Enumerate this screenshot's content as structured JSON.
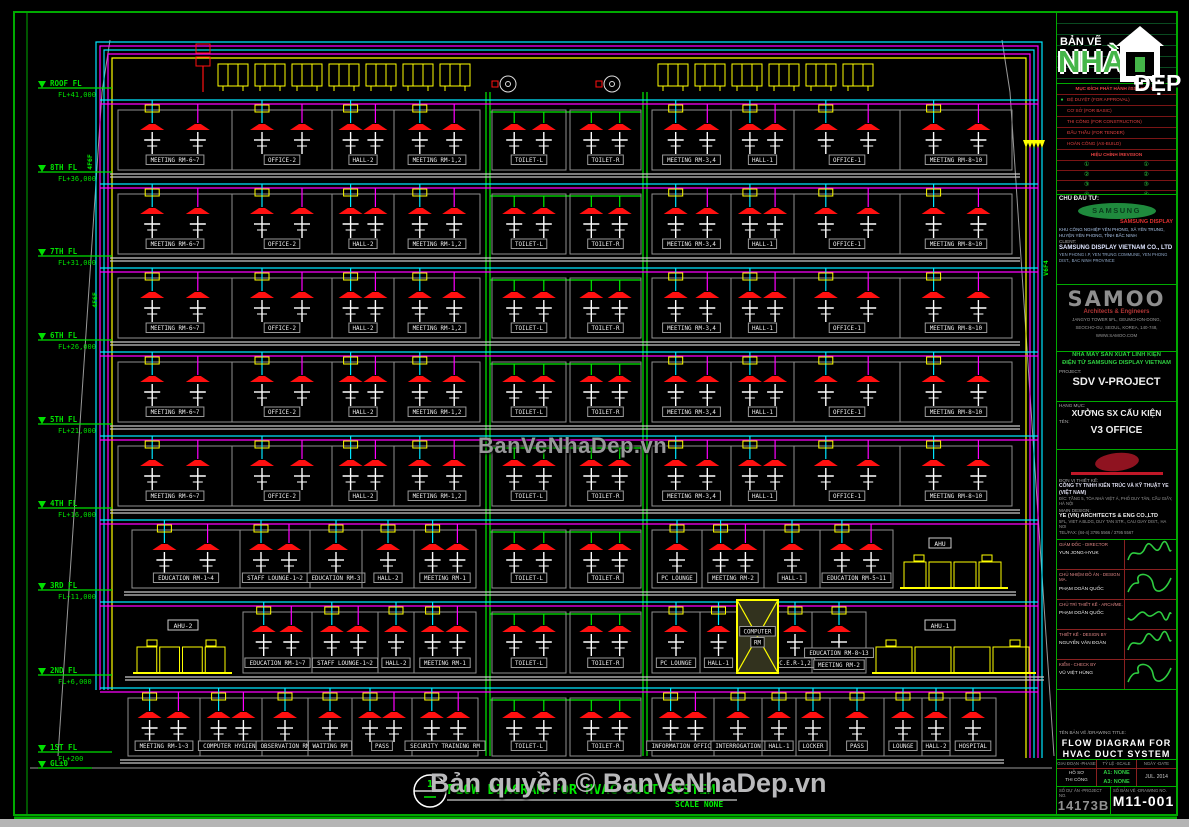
{
  "colors": {
    "supply": "#00e5ff",
    "return": "#ff00ff",
    "exhaust": "#00ee00",
    "equipment": "#ffff00",
    "diffuser": "#ff1010",
    "level": "#00e000",
    "border": "#00aa00"
  },
  "watermarks": {
    "center": "BanVeNhaDep.vn",
    "bottom": "Bản quyền © BanVeNhaDep.vn"
  },
  "footer": {
    "bubble_no": "1",
    "title": "FLOW DIAGRAM FOR HVAC DUCT SYSTEM",
    "scale": "SCALE  NONE"
  },
  "levels": [
    {
      "label": "ROOF FL",
      "elev": "FL+41,000",
      "y": 88
    },
    {
      "label": "8TH FL",
      "elev": "FL+36,000",
      "y": 172
    },
    {
      "label": "7TH FL",
      "elev": "FL+31,000",
      "y": 256
    },
    {
      "label": "6TH FL",
      "elev": "FL+26,000",
      "y": 340
    },
    {
      "label": "5TH FL",
      "elev": "FL+21,000",
      "y": 424
    },
    {
      "label": "4TH FL",
      "elev": "FL+16,000",
      "y": 508
    },
    {
      "label": "3RD FL",
      "elev": "FL+11,000",
      "y": 590
    },
    {
      "label": "2ND FL",
      "elev": "FL+6,000",
      "y": 675
    },
    {
      "label": "1ST FL",
      "elev": "FL+200",
      "y": 752
    },
    {
      "label": "GL±0",
      "elev": "",
      "y": 768
    }
  ],
  "riser_tags": [
    {
      "text": "4F6F",
      "x": 92,
      "y": 162,
      "rot": -90
    },
    {
      "text": "4F6F",
      "x": 97,
      "y": 300,
      "rot": -90
    },
    {
      "text": "V6F4",
      "x": 1048,
      "y": 268,
      "rot": -90
    }
  ],
  "rooftop": {
    "groups": [
      [
        218,
        478
      ],
      [
        658,
        898
      ]
    ],
    "fans": [
      {
        "x": 508
      },
      {
        "x": 612
      }
    ]
  },
  "typical_rooms": [
    [
      "MEETING RM-6~7",
      118,
      232
    ],
    [
      "OFFICE-2",
      232,
      332
    ],
    [
      "HALL-2",
      332,
      394
    ],
    [
      "MEETING RM-1,2",
      394,
      480
    ],
    [
      "TOILET-L",
      492,
      566,
      "ex"
    ],
    [
      "TOILET-R",
      570,
      641,
      "ex"
    ],
    [
      "MEETING RM-3,4",
      652,
      731
    ],
    [
      "HALL-1",
      731,
      794
    ],
    [
      "OFFICE-1",
      794,
      900
    ],
    [
      "MEETING RM-8~10",
      900,
      1012
    ]
  ],
  "floors": [
    {
      "id": "8F",
      "top": 96,
      "bottom": 170,
      "rooms": "typical"
    },
    {
      "id": "7F",
      "top": 180,
      "bottom": 254,
      "rooms": "typical"
    },
    {
      "id": "6F",
      "top": 264,
      "bottom": 338,
      "rooms": "typical"
    },
    {
      "id": "5F",
      "top": 348,
      "bottom": 422,
      "rooms": "typical"
    },
    {
      "id": "4F",
      "top": 432,
      "bottom": 506,
      "rooms": "typical"
    },
    {
      "id": "3F",
      "top": 516,
      "bottom": 588,
      "rooms": [
        [
          "EDUCATION RM-1~4",
          132,
          240
        ],
        [
          "STAFF LOUNGE-1~2",
          240,
          310
        ],
        [
          "EDUCATION RM-3",
          310,
          362
        ],
        [
          "HALL-2",
          362,
          414
        ],
        [
          "MEETING RM-1",
          414,
          476
        ],
        [
          "TOILET-L",
          492,
          566,
          "ex"
        ],
        [
          "TOILET-R",
          570,
          641,
          "ex"
        ],
        [
          "PC LOUNGE",
          652,
          702
        ],
        [
          "MEETING RM-2",
          702,
          764
        ],
        [
          "HALL-1",
          764,
          820
        ],
        [
          "EDUCATION RM-5~11",
          820,
          893
        ]
      ],
      "ahu": [
        {
          "label": "AHU",
          "x1": 900,
          "x2": 1008,
          "label_x": 940
        }
      ]
    },
    {
      "id": "2F",
      "top": 598,
      "bottom": 673,
      "rooms": [
        [
          "EDUCATION RM-1~7",
          243,
          312
        ],
        [
          "STAFF LOUNGE-1~2",
          312,
          378
        ],
        [
          "HALL-2",
          378,
          414
        ],
        [
          "MEETING RM-1",
          414,
          476
        ],
        [
          "TOILET-L",
          492,
          566,
          "ex"
        ],
        [
          "TOILET-R",
          570,
          641,
          "ex"
        ],
        [
          "PC LOUNGE",
          652,
          700
        ],
        [
          "HALL-1",
          700,
          737
        ],
        [
          "C.E.R-1,2",
          778,
          812
        ],
        [
          "EDUCATION RM-8~13",
          812,
          866,
          null,
          "MEETING RM-2"
        ]
      ],
      "ahu": [
        {
          "label": "AHU-2",
          "x1": 133,
          "x2": 232,
          "label_x": 183
        },
        {
          "label": "AHU-1",
          "x1": 872,
          "x2": 1036,
          "label_x": 940
        }
      ],
      "special": {
        "label": "COMPUTER RM",
        "x1": 737,
        "x2": 778
      }
    },
    {
      "id": "1F",
      "top": 684,
      "bottom": 756,
      "rooms": [
        [
          "MEETING RM-1~3",
          128,
          200
        ],
        [
          "COMPUTER HYGIENE",
          200,
          262
        ],
        [
          "OBSERVATION RM",
          262,
          308
        ],
        [
          "WAITING RM",
          308,
          352
        ],
        [
          "PASS",
          352,
          412
        ],
        [
          "SECURITY TRAINING RM",
          412,
          478
        ],
        [
          "TOILET-L",
          492,
          566,
          "ex"
        ],
        [
          "TOILET-R",
          570,
          641,
          "ex"
        ],
        [
          "INFORMATION OFFICE",
          652,
          714
        ],
        [
          "INTERROGATION",
          714,
          762
        ],
        [
          "HALL-1",
          762,
          796
        ],
        [
          "LOCKER",
          796,
          830
        ],
        [
          "PASS",
          830,
          884
        ],
        [
          "LOUNGE",
          884,
          922
        ],
        [
          "HALL-2",
          922,
          950
        ],
        [
          "HOSPITAL",
          950,
          996
        ]
      ]
    }
  ],
  "title_block": {
    "logo": {
      "line1": "BẢN VẼ",
      "line2": "NHÀ",
      "line3": "ĐẸP"
    },
    "issued": {
      "header": "MỤC ĐÍCH PHÁT HÀNH /ISSUED FOR",
      "rows": [
        {
          "label": "ĐỆ DUYỆT (FOR APPROVAL)",
          "active": true
        },
        {
          "label": "CƠ SỞ (FOR BASIC)",
          "active": false
        },
        {
          "label": "THI CÔNG (FOR CONSTRUCTION)",
          "active": false
        },
        {
          "label": "ĐẤU THẦU (FOR TENDER)",
          "active": false
        },
        {
          "label": "HOÀN CÔNG (AS-BUILD)",
          "active": false
        }
      ],
      "revision_header": "HIỆU CHỈNH /REVISION",
      "revision_rows": [
        [
          "①",
          "①"
        ],
        [
          "②",
          "②"
        ],
        [
          "③",
          "③"
        ],
        [
          "④",
          "④"
        ]
      ]
    },
    "client": {
      "label": "CHỦ ĐẦU TƯ:",
      "logo_text": "SAMSUNG",
      "brand": "SAMSUNG DISPLAY",
      "desc_vn": "KHU CÔNG NGHIỆP YÊN PHONG, XÃ YÊN TRUNG, HUYỆN YÊN PHONG, TỈNH BẮC NINH",
      "client_label": "CLIENT:",
      "name": "SAMSUNG DISPLAY VIETNAM CO., LTD",
      "address": "YEN PHONG I.P, YEN TRUNG COMMUNE, YEN PHONG DIST., BAC NINH PROVINCE"
    },
    "architect": {
      "name": "SAMOO",
      "tagline": "Architects & Engineers",
      "addr1": "JANGYO TOWER 5FL, GEUMCHON-DONG,",
      "addr2": "SEOCHO-GU, SEOUL, KOREA, 140-748,",
      "addr3": "WWW.SAMOO.COM"
    },
    "project": {
      "vn_line1": "NHÀ MÁY SẢN XUẤT LINH KIỆN",
      "vn_line2": "ĐIỆN TỬ SAMSUNG DISPLAY VIETNAM",
      "project_label": "PROJECT:",
      "project_name": "SDV V-PROJECT",
      "item_label": "HẠNG MỤC:",
      "item_name": "XƯỞNG SX CẤU KIỆN",
      "part_label": "TÊN:",
      "part_name": "V3 OFFICE"
    },
    "designer": {
      "label": "ĐƠN VỊ THIẾT KẾ:",
      "company_vn": "CÔNG TY TNHH KIẾN TRÚC VÀ KỸ THUẬT YE (VIỆT NAM)",
      "addr_vn": "Đ/C: TẦNG 5, TÒA NHÀ VIỆT Á, PHỐ DUY TÂN, CẦU GIẤY, HÀ NỘI",
      "main_label": "MAIN DESIGN:",
      "company_en": "YE (VN) ARCHITECTS & ENG CO.,LTD",
      "addr_en": "5FL, VIET A BLDG, DUY TAN STR., CAU GIAY DIST., HA NOI",
      "tel": "TEL/FAX: (84-4) 3795 5566 / 3795 5567"
    },
    "signatures": [
      {
        "role": "GIÁM ĐỐC - DIRECTOR",
        "name": "YUN JONG-HYUK"
      },
      {
        "role": "CHỦ NHIỆM ĐỒ ÁN - DESIGN MA.",
        "name": "PHẠM DOÃN QUỐC"
      },
      {
        "role": "CHỦ TRÌ THIẾT KẾ - ARCH/ME.",
        "name": "PHẠM DOÃN QUỐC"
      },
      {
        "role": "THIẾT KẾ - DESIGN BY",
        "name": "NGUYỄN VĂN ĐOÀN"
      },
      {
        "role": "KIỂM - CHECK BY",
        "name": "VŨ VIỆT HÙNG"
      }
    ],
    "drawing": {
      "title_label": "TÊN BẢN VẼ /DRAWING TITLE:",
      "title_line1": "FLOW DIAGRAM FOR",
      "title_line2": "HVAC DUCT SYSTEM",
      "phase_label": "GIAI ĐOẠN -PHASE",
      "scale_label": "TỶ LỆ -SCALE",
      "date_label": "NGÀY -DATE",
      "phase_value1": "HỒ SƠ",
      "phase_value2": "THI CÔNG",
      "scale_value1": "A1: NONE",
      "scale_value2": "A3: NONE",
      "date_value": "JUL. 2014",
      "project_no_label": "SỐ DỰ ÁN -PROJECT NO.",
      "project_no": "14173B",
      "drawing_no_label": "SỐ BẢN VẼ -DRAWING NO.",
      "drawing_no": "M11-001"
    }
  }
}
